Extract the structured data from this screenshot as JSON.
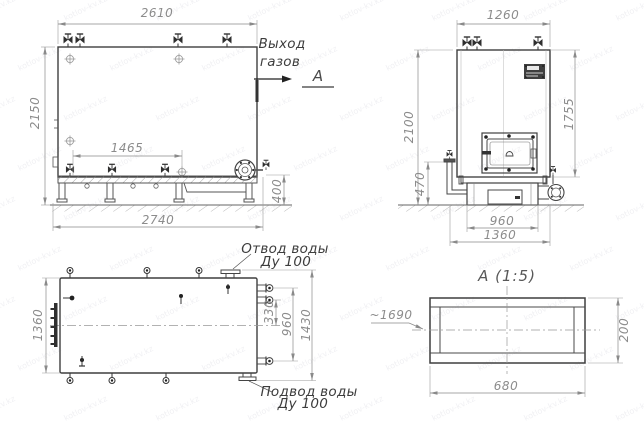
{
  "watermark": {
    "text": "kotlov-kv.kz"
  },
  "side_view": {
    "dim_width_top": "2610",
    "dim_height_left": "2150",
    "dim_valves_span": "1465",
    "dim_base_length": "2740",
    "dim_base_height": "400",
    "label_gas_outlet_line1": "Выход",
    "label_gas_outlet_line2": "газов",
    "section_mark": "А"
  },
  "front_view": {
    "dim_width_top": "1260",
    "dim_height_left": "2100",
    "dim_body_height_right": "1755",
    "dim_pipe_height": "470",
    "dim_hearth_width": "960",
    "dim_base_width": "1360"
  },
  "plan_view": {
    "dim_width_left": "1360",
    "dim_stub_to_center": "330",
    "dim_stub_span": "960",
    "dim_overall": "1430",
    "label_water_outlet_line1": "Отвод воды",
    "label_water_outlet_line2": "Ду 100",
    "label_water_inlet_line1": "Подвод воды",
    "label_water_inlet_line2": "Ду 100"
  },
  "section_view": {
    "title": "А (1:5)",
    "dim_length_ref": "~1690",
    "dim_height": "200",
    "dim_width": "680"
  }
}
